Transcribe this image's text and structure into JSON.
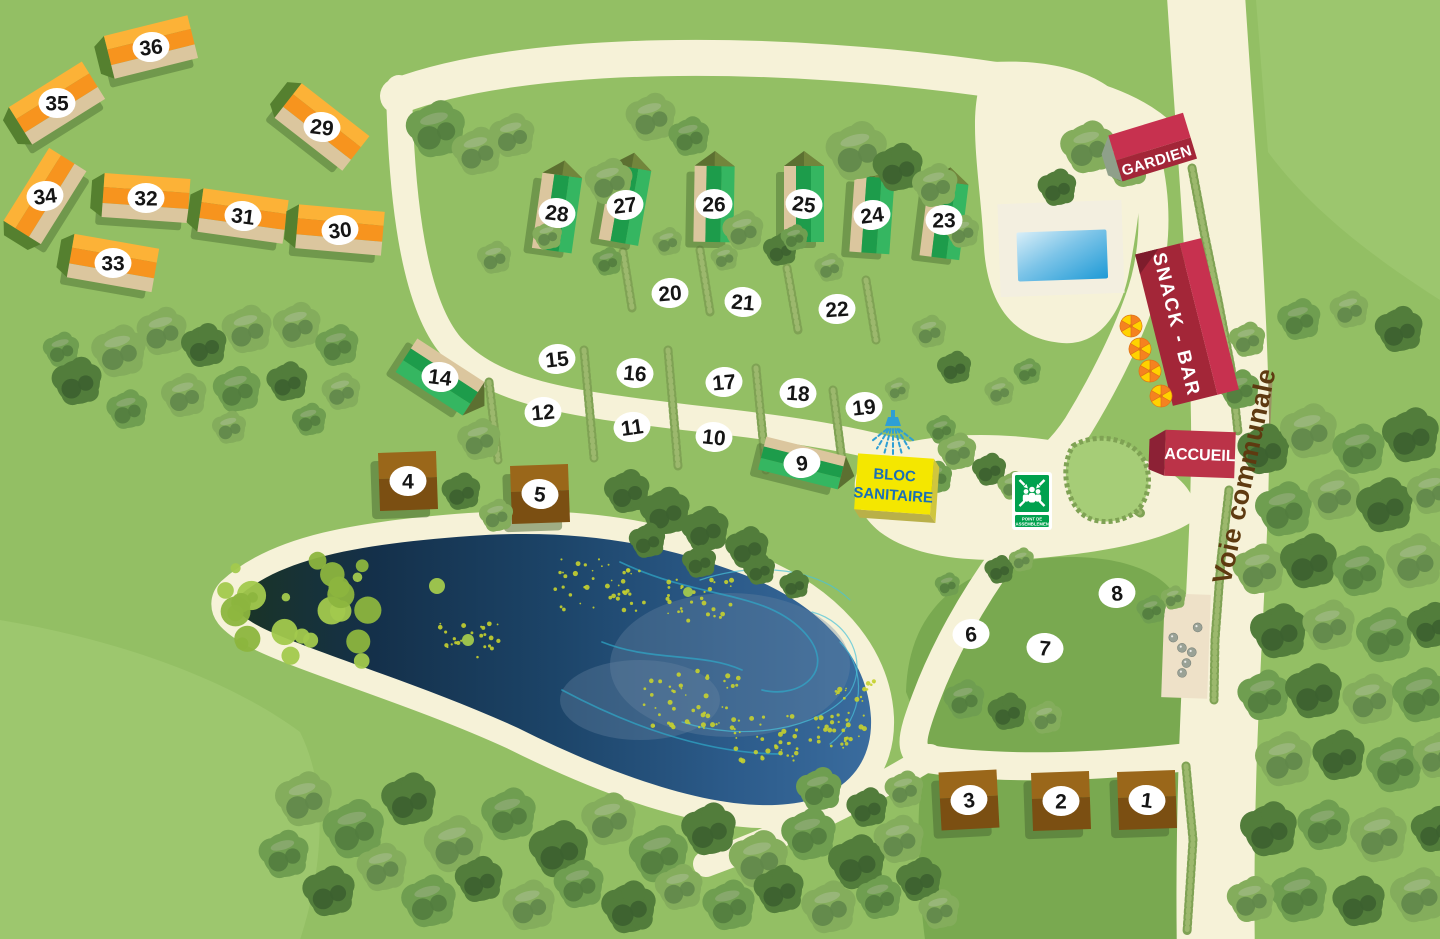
{
  "labels": {
    "road": "Voie communale",
    "guard": "GARDIEN",
    "snack": "SNACK - BAR",
    "reception": "ACCUEIL",
    "sanitary_1": "BLOC",
    "sanitary_2": "SANITAIRE",
    "assembly_1": "POINT DE",
    "assembly_2": "RASSEMBLEMENT"
  },
  "colors": {
    "grass": "#93bf64",
    "grass_light": "#a6cd77",
    "field": "#79a950",
    "path": "#f6f2d8",
    "dirt": "#9b8a63",
    "hedge_dark": "#7fa254",
    "hedge_light": "#9cb86d",
    "pond_green_tip": "#1a3424",
    "swirl_a": "#2fa9c9",
    "swirl_b": "#49c2d8",
    "mist": "#6a87a3",
    "algae": "#c6d22f",
    "lily_a": "#8cb53e",
    "lily_b": "#a2c94d",
    "orange_light": "#fcb237",
    "orange_main": "#f7941e",
    "orange_gable": "#55802f",
    "chalet_tan": "#dbc69e",
    "chalet_shadow": "#47682f",
    "green_dark": "#1d9c4b",
    "green_light": "#35b661",
    "green_roof": "#5c7031",
    "green_roof_light": "#72863c",
    "brown_top": "#9a671a",
    "brown_bottom": "#7b4f12",
    "red_roof": "#c7314f",
    "red_main": "#a32638",
    "red_dark": "#7e1c2c",
    "red_mid": "#bb3348",
    "red_gable2": "#8c2135",
    "guard_gable": "#8fa08a",
    "yellow": "#f4e700",
    "yellow_side": "#cfc63e",
    "yellow_side2": "#b9b049",
    "blue_text": "#1a6fb5",
    "blue_icon": "#2e9fd4",
    "sign_green": "#00a14e",
    "marker_bg": "#ffffff",
    "marker_text": "#151515",
    "label_brown": "#5e3a10",
    "pool_deck": "#f3efe0",
    "pool_light": "#d8eef8",
    "pool_mid": "#7cc4e8",
    "pool_deep": "#1e9ad6",
    "sand": "#eee1c8",
    "ball": "#9aa296",
    "umb_orange": "#f58220",
    "umb_yellow": "#ffd200"
  },
  "markers": {
    "pitches": [
      {
        "n": "6",
        "x": 971,
        "y": 634,
        "rot": -5
      },
      {
        "n": "7",
        "x": 1045,
        "y": 648,
        "rot": 5
      },
      {
        "n": "8",
        "x": 1117,
        "y": 593,
        "rot": -6
      },
      {
        "n": "10",
        "x": 714,
        "y": 437,
        "rot": 6
      },
      {
        "n": "11",
        "x": 632,
        "y": 427,
        "rot": -8
      },
      {
        "n": "12",
        "x": 543,
        "y": 412,
        "rot": -5
      },
      {
        "n": "15",
        "x": 557,
        "y": 359,
        "rot": -6
      },
      {
        "n": "16",
        "x": 635,
        "y": 373,
        "rot": 5
      },
      {
        "n": "17",
        "x": 724,
        "y": 382,
        "rot": -5
      },
      {
        "n": "18",
        "x": 798,
        "y": 393,
        "rot": 4
      },
      {
        "n": "19",
        "x": 864,
        "y": 407,
        "rot": -6
      },
      {
        "n": "20",
        "x": 670,
        "y": 293,
        "rot": -5
      },
      {
        "n": "21",
        "x": 743,
        "y": 302,
        "rot": 5
      },
      {
        "n": "22",
        "x": 837,
        "y": 309,
        "rot": -4
      }
    ]
  },
  "chalets": {
    "orange": [
      {
        "n": "36",
        "x": 151,
        "y": 47,
        "rot": -14
      },
      {
        "n": "35",
        "x": 57,
        "y": 103,
        "rot": -32
      },
      {
        "n": "29",
        "x": 322,
        "y": 127,
        "rot": 38
      },
      {
        "n": "34",
        "x": 45,
        "y": 196,
        "rot": -58
      },
      {
        "n": "32",
        "x": 146,
        "y": 198,
        "rot": 4
      },
      {
        "n": "31",
        "x": 243,
        "y": 216,
        "rot": 8
      },
      {
        "n": "30",
        "x": 340,
        "y": 230,
        "rot": 5
      },
      {
        "n": "33",
        "x": 113,
        "y": 263,
        "rot": 10
      }
    ],
    "green_tall": [
      {
        "n": "28",
        "x": 557,
        "y": 213,
        "rot": 8
      },
      {
        "n": "27",
        "x": 625,
        "y": 205,
        "rot": 10
      },
      {
        "n": "26",
        "x": 714,
        "y": 204,
        "rot": 1
      },
      {
        "n": "25",
        "x": 804,
        "y": 204,
        "rot": 0
      },
      {
        "n": "24",
        "x": 872,
        "y": 215,
        "rot": 4
      },
      {
        "n": "23",
        "x": 944,
        "y": 220,
        "rot": 7
      }
    ],
    "green_long": [
      {
        "n": "14",
        "x": 440,
        "y": 377,
        "rot": 33,
        "len": 80,
        "h": 40
      },
      {
        "n": "9",
        "x": 802,
        "y": 463,
        "rot": 14,
        "len": 82,
        "h": 34
      }
    ],
    "brown": [
      {
        "n": "4",
        "x": 408,
        "y": 481,
        "rot": -2
      },
      {
        "n": "5",
        "x": 540,
        "y": 494,
        "rot": -2
      },
      {
        "n": "3",
        "x": 969,
        "y": 800,
        "rot": -3
      },
      {
        "n": "2",
        "x": 1061,
        "y": 801,
        "rot": -2
      },
      {
        "n": "1",
        "x": 1147,
        "y": 800,
        "rot": -2
      }
    ]
  },
  "buildings": {
    "guard": {
      "x": 1153,
      "y": 148,
      "rot": -17
    },
    "snack": {
      "x": 1187,
      "y": 322,
      "rot": -14
    },
    "reception": {
      "x": 1200,
      "y": 454,
      "rot": 2
    },
    "sanitary": {
      "x": 894,
      "y": 484,
      "rot": 4
    },
    "shower": {
      "x": 893,
      "y": 424
    },
    "assembly": {
      "x": 1012,
      "y": 472
    },
    "pool": {
      "x": 1061,
      "y": 248,
      "rot": -2
    },
    "petanque": {
      "x": 1186,
      "y": 646,
      "rot": 2,
      "balls": [
        [
          -13,
          -8
        ],
        [
          -4,
          2
        ],
        [
          6,
          6
        ],
        [
          11,
          -19
        ],
        [
          1,
          17
        ],
        [
          -3,
          27
        ]
      ]
    },
    "umbrellas": [
      [
        1131,
        326
      ],
      [
        1140,
        349
      ],
      [
        1150,
        371
      ],
      [
        1161,
        396
      ]
    ]
  },
  "paths": {
    "road": {
      "d": "M 1205,-20 C 1215,140 1228,280 1230,420 C 1232,560 1212,720 1216,960",
      "w": 78
    },
    "road_dirt": {
      "d": "M 1266,380 C 1262,480 1252,600 1250,690",
      "w": 13
    },
    "loop_top": {
      "d": "M 398,96 C 520,50 770,46 1010,82 C 1090,94 1136,112 1162,138",
      "w": 36
    },
    "loop_left": {
      "d": "M 399,88 C 401,190 412,300 451,346 C 493,392 562,403 692,418 C 802,430 870,441 938,464",
      "w": 26
    },
    "guard_path": {
      "d": "M 1146,158 C 1159,212 1154,262 1139,302 C 1124,344 1100,390 1078,426 C 1061,452 1040,470 1016,482",
      "w": 30
    },
    "south_path": {
      "d": "M 1004,556 C 972,600 944,650 926,698 C 910,740 908,753 928,759 C 1012,772 1122,766 1230,752",
      "w": 28
    },
    "south_spur": {
      "d": "M 930,757 C 872,792 800,830 706,864",
      "w": 26
    },
    "pool_plaza": "M 992,62 C 1070,58 1121,82 1135,120 C 1148,158 1139,220 1129,272 C 1121,315 1098,346 1062,343 C 1014,339 988,306 984,248 C 980,170 962,96 992,62 Z",
    "main_plaza": "M 872,452 C 940,428 1020,432 1095,448 C 1140,456 1196,470 1197,518 C 1170,540 1106,552 1040,558 C 965,564 912,556 880,532 C 850,508 846,472 872,452 Z"
  },
  "pond": {
    "d": "M 237,598 C 280,558 360,544 470,536 C 580,528 662,544 742,574 C 822,604 868,658 871,718 C 873,768 840,799 788,804 C 718,812 618,778 518,728 C 418,682 298,648 255,624 C 237,613 230,606 237,598 Z",
    "ring_w": 46,
    "swirls": [
      "M 620,562 C 700,600 762,590 802,630 C 840,668 802,700 762,690",
      "M 682,722 C 742,742 820,730 850,692 C 868,662 850,622 812,612",
      "M 562,690 C 622,722 702,754 782,754",
      "M 840,642 C 868,670 864,718 830,744",
      "M 602,642 C 652,662 702,652 742,670",
      "M 700,580 C 760,560 820,570 850,600"
    ],
    "mist": [
      [
        730,
        665,
        120,
        72
      ],
      [
        640,
        700,
        80,
        40
      ]
    ],
    "algae": [
      [
        600,
        585,
        14,
        45
      ],
      [
        700,
        600,
        10,
        35
      ],
      [
        470,
        640,
        8,
        30
      ],
      [
        690,
        700,
        16,
        50
      ],
      [
        760,
        740,
        12,
        40
      ],
      [
        840,
        730,
        10,
        30
      ],
      [
        855,
        690,
        6,
        20
      ]
    ],
    "lilies": {
      "cx": 300,
      "cy": 612,
      "n": 26,
      "sx": 75,
      "sy": 52
    },
    "lily_singles": [
      [
        437,
        586,
        8
      ],
      [
        468,
        640,
        6
      ],
      [
        688,
        592,
        5
      ]
    ]
  },
  "patches": {
    "field_a": "M 906,692 C 908,612 958,566 1046,558 C 1118,552 1170,572 1180,606 L 1188,742 C 1100,762 980,762 928,748 Z",
    "field_b": "M 922,772 L 1188,764 C 1194,822 1190,880 1192,940 L 925,940 C 918,885 916,820 922,772 Z",
    "light_bl": "M 0,620 C 120,640 230,680 300,732 C 330,792 322,872 300,940 L 0,940 Z",
    "light_tr": "M 1256,0 L 1440,0 L 1440,300 C 1380,262 1312,212 1268,152 Z",
    "island": "M 1073,446 C 1092,434 1122,436 1138,452 C 1152,466 1152,494 1138,510 C 1122,524 1094,526 1080,512 C 1066,498 1060,466 1073,446 Z"
  },
  "hedges": {
    "cross": [
      [
        623,
        252,
        632,
        308
      ],
      [
        700,
        250,
        710,
        312
      ],
      [
        787,
        268,
        798,
        330
      ],
      [
        866,
        280,
        876,
        340
      ],
      [
        489,
        382,
        498,
        460
      ],
      [
        584,
        350,
        594,
        458
      ],
      [
        668,
        350,
        678,
        466
      ],
      [
        756,
        368,
        766,
        470
      ],
      [
        833,
        390,
        843,
        468
      ],
      [
        1118,
        498,
        1142,
        514
      ]
    ],
    "road": [
      [
        [
          1192,
          168
        ],
        [
          1204,
          232
        ],
        [
          1218,
          300
        ],
        [
          1231,
          368
        ],
        [
          1238,
          432
        ]
      ],
      [
        [
          1229,
          490
        ],
        [
          1221,
          560
        ],
        [
          1215,
          640
        ],
        [
          1214,
          700
        ]
      ],
      [
        [
          1186,
          766
        ],
        [
          1193,
          840
        ],
        [
          1187,
          932
        ]
      ]
    ]
  },
  "trees": [
    [
      437,
      130,
      26,
      1
    ],
    [
      478,
      152,
      22,
      0
    ],
    [
      513,
      136,
      20,
      0
    ],
    [
      610,
      182,
      21,
      0
    ],
    [
      652,
      118,
      22,
      0
    ],
    [
      690,
      137,
      18,
      1
    ],
    [
      744,
      231,
      18,
      0
    ],
    [
      781,
      250,
      15,
      2
    ],
    [
      858,
      152,
      27,
      0
    ],
    [
      899,
      168,
      22,
      2
    ],
    [
      936,
      186,
      20,
      0
    ],
    [
      963,
      232,
      15,
      0
    ],
    [
      1058,
      188,
      17,
      2
    ],
    [
      1089,
      148,
      24,
      0
    ],
    [
      1128,
      167,
      19,
      0
    ],
    [
      62,
      350,
      16,
      1
    ],
    [
      78,
      382,
      22,
      2
    ],
    [
      120,
      352,
      24,
      0
    ],
    [
      163,
      332,
      22,
      0
    ],
    [
      205,
      346,
      20,
      2
    ],
    [
      248,
      330,
      22,
      0
    ],
    [
      298,
      326,
      21,
      0
    ],
    [
      338,
      346,
      19,
      1
    ],
    [
      185,
      396,
      20,
      0
    ],
    [
      238,
      390,
      21,
      1
    ],
    [
      288,
      382,
      18,
      2
    ],
    [
      128,
      410,
      18,
      1
    ],
    [
      342,
      392,
      17,
      0
    ],
    [
      230,
      428,
      15,
      0
    ],
    [
      310,
      420,
      15,
      1
    ],
    [
      495,
      258,
      15,
      0
    ],
    [
      548,
      236,
      13,
      0
    ],
    [
      608,
      262,
      13,
      1
    ],
    [
      668,
      242,
      13,
      0
    ],
    [
      725,
      258,
      12,
      0
    ],
    [
      795,
      238,
      12,
      1
    ],
    [
      830,
      268,
      13,
      0
    ],
    [
      930,
      332,
      15,
      0
    ],
    [
      955,
      368,
      15,
      2
    ],
    [
      1000,
      392,
      13,
      0
    ],
    [
      1028,
      372,
      12,
      1
    ],
    [
      898,
      390,
      11,
      0
    ],
    [
      480,
      440,
      19,
      0
    ],
    [
      462,
      492,
      17,
      2
    ],
    [
      497,
      516,
      15,
      0
    ],
    [
      628,
      492,
      20,
      2
    ],
    [
      666,
      512,
      22,
      2
    ],
    [
      706,
      530,
      21,
      2
    ],
    [
      748,
      548,
      19,
      2
    ],
    [
      648,
      541,
      16,
      2
    ],
    [
      700,
      562,
      15,
      2
    ],
    [
      760,
      570,
      14,
      2
    ],
    [
      795,
      585,
      13,
      2
    ],
    [
      942,
      430,
      13,
      1
    ],
    [
      958,
      452,
      17,
      0
    ],
    [
      990,
      470,
      15,
      2
    ],
    [
      1013,
      486,
      13,
      0
    ],
    [
      936,
      478,
      15,
      1
    ],
    [
      1000,
      570,
      13,
      2
    ],
    [
      1022,
      560,
      11,
      0
    ],
    [
      948,
      585,
      11,
      1
    ],
    [
      1152,
      610,
      13,
      1
    ],
    [
      1174,
      598,
      11,
      0
    ],
    [
      965,
      700,
      18,
      1
    ],
    [
      1008,
      712,
      17,
      2
    ],
    [
      1046,
      718,
      15,
      0
    ],
    [
      820,
      790,
      20,
      1
    ],
    [
      868,
      808,
      18,
      2
    ],
    [
      905,
      790,
      17,
      0
    ],
    [
      305,
      800,
      25,
      0
    ],
    [
      355,
      830,
      27,
      1
    ],
    [
      410,
      800,
      24,
      2
    ],
    [
      455,
      845,
      26,
      0
    ],
    [
      510,
      815,
      24,
      1
    ],
    [
      560,
      850,
      26,
      2
    ],
    [
      610,
      820,
      24,
      0
    ],
    [
      660,
      855,
      26,
      1
    ],
    [
      710,
      830,
      24,
      2
    ],
    [
      760,
      860,
      26,
      0
    ],
    [
      810,
      835,
      24,
      1
    ],
    [
      858,
      863,
      25,
      2
    ],
    [
      900,
      840,
      22,
      0
    ],
    [
      285,
      855,
      22,
      1
    ],
    [
      383,
      868,
      22,
      0
    ],
    [
      480,
      880,
      21,
      2
    ],
    [
      580,
      885,
      22,
      1
    ],
    [
      680,
      888,
      21,
      0
    ],
    [
      780,
      890,
      22,
      2
    ],
    [
      880,
      898,
      20,
      1
    ],
    [
      330,
      892,
      23,
      2
    ],
    [
      430,
      902,
      24,
      1
    ],
    [
      530,
      906,
      23,
      0
    ],
    [
      630,
      908,
      24,
      2
    ],
    [
      730,
      906,
      23,
      1
    ],
    [
      830,
      908,
      24,
      0
    ],
    [
      920,
      880,
      20,
      2
    ],
    [
      940,
      910,
      18,
      0
    ],
    [
      1300,
      320,
      19,
      1
    ],
    [
      1350,
      310,
      17,
      0
    ],
    [
      1400,
      330,
      21,
      2
    ],
    [
      1240,
      390,
      18,
      1
    ],
    [
      1248,
      340,
      16,
      0
    ],
    [
      1265,
      450,
      23,
      2
    ],
    [
      1310,
      432,
      25,
      0
    ],
    [
      1360,
      450,
      23,
      1
    ],
    [
      1412,
      436,
      25,
      2
    ],
    [
      1285,
      510,
      25,
      1
    ],
    [
      1335,
      496,
      23,
      0
    ],
    [
      1386,
      506,
      25,
      2
    ],
    [
      1432,
      492,
      21,
      0
    ],
    [
      1260,
      570,
      23,
      0
    ],
    [
      1310,
      562,
      25,
      2
    ],
    [
      1360,
      572,
      23,
      1
    ],
    [
      1416,
      562,
      25,
      0
    ],
    [
      1280,
      632,
      25,
      2
    ],
    [
      1330,
      626,
      23,
      0
    ],
    [
      1386,
      636,
      25,
      1
    ],
    [
      1432,
      626,
      21,
      2
    ],
    [
      1265,
      696,
      23,
      1
    ],
    [
      1315,
      692,
      25,
      2
    ],
    [
      1370,
      700,
      23,
      0
    ],
    [
      1422,
      696,
      25,
      1
    ],
    [
      1285,
      760,
      25,
      0
    ],
    [
      1340,
      756,
      23,
      2
    ],
    [
      1396,
      766,
      25,
      1
    ],
    [
      1438,
      756,
      21,
      0
    ],
    [
      1270,
      830,
      25,
      2
    ],
    [
      1325,
      826,
      23,
      1
    ],
    [
      1380,
      836,
      25,
      0
    ],
    [
      1436,
      830,
      21,
      2
    ],
    [
      1300,
      896,
      25,
      1
    ],
    [
      1360,
      902,
      23,
      2
    ],
    [
      1420,
      896,
      25,
      0
    ],
    [
      1252,
      900,
      21,
      0
    ]
  ],
  "road_label": {
    "x": 1253,
    "y": 478,
    "rot": -78
  }
}
